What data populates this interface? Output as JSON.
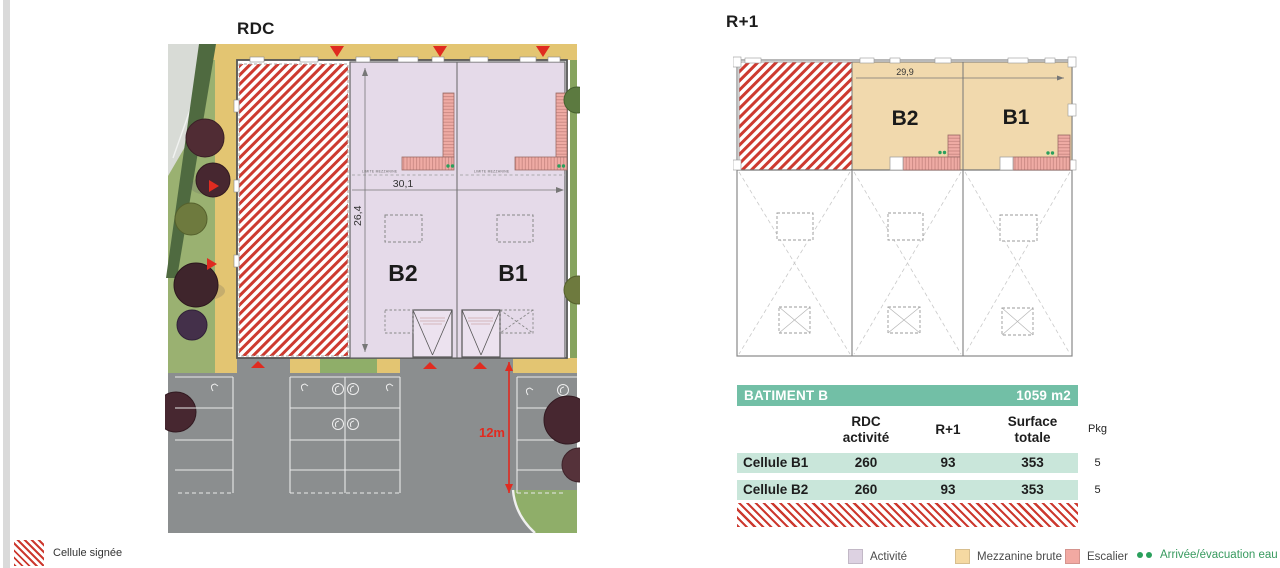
{
  "rdc": {
    "title": "RDC",
    "cell_b2": "B2",
    "cell_b1": "B1",
    "dim_width": "30,1",
    "dim_height": "26,4",
    "limite_mezzanine": "LIMITE MEZZANINE",
    "parking_dim": "12m"
  },
  "r1": {
    "title": "R+1",
    "cell_b2": "B2",
    "cell_b1": "B1",
    "dim_width": "29,9"
  },
  "table": {
    "title": "BATIMENT B",
    "total": "1059 m2",
    "col_rdc": "RDC\nactivité",
    "col_r1": "R+1",
    "col_total": "Surface\ntotale",
    "col_pkg": "Pkg",
    "rows": [
      {
        "name": "Cellule B1",
        "rdc": "260",
        "r1": "93",
        "total": "353",
        "pkg": "5"
      },
      {
        "name": "Cellule B2",
        "rdc": "260",
        "r1": "93",
        "total": "353",
        "pkg": "5"
      }
    ]
  },
  "legend_left": {
    "label": "Cellule signée"
  },
  "legend": {
    "activite": "Activité",
    "mezzanine": "Mezzanine brute",
    "escalier": "Escalier",
    "eau": "Arrivée/évacuation eau"
  },
  "colors": {
    "activite": "#e5dae9",
    "mezzanine_brute": "#f1d9ad",
    "escalier": "#efaba4",
    "hatch_red": "#cd3a30",
    "accent_red": "#e02b20",
    "table_header_green": "#72bfa6",
    "table_row_mint": "#c9e6da",
    "eau_green": "#2aa05c",
    "asphalt": "#8b8e8f",
    "path_yellow": "#e3c572",
    "grass": "#9ab171"
  }
}
